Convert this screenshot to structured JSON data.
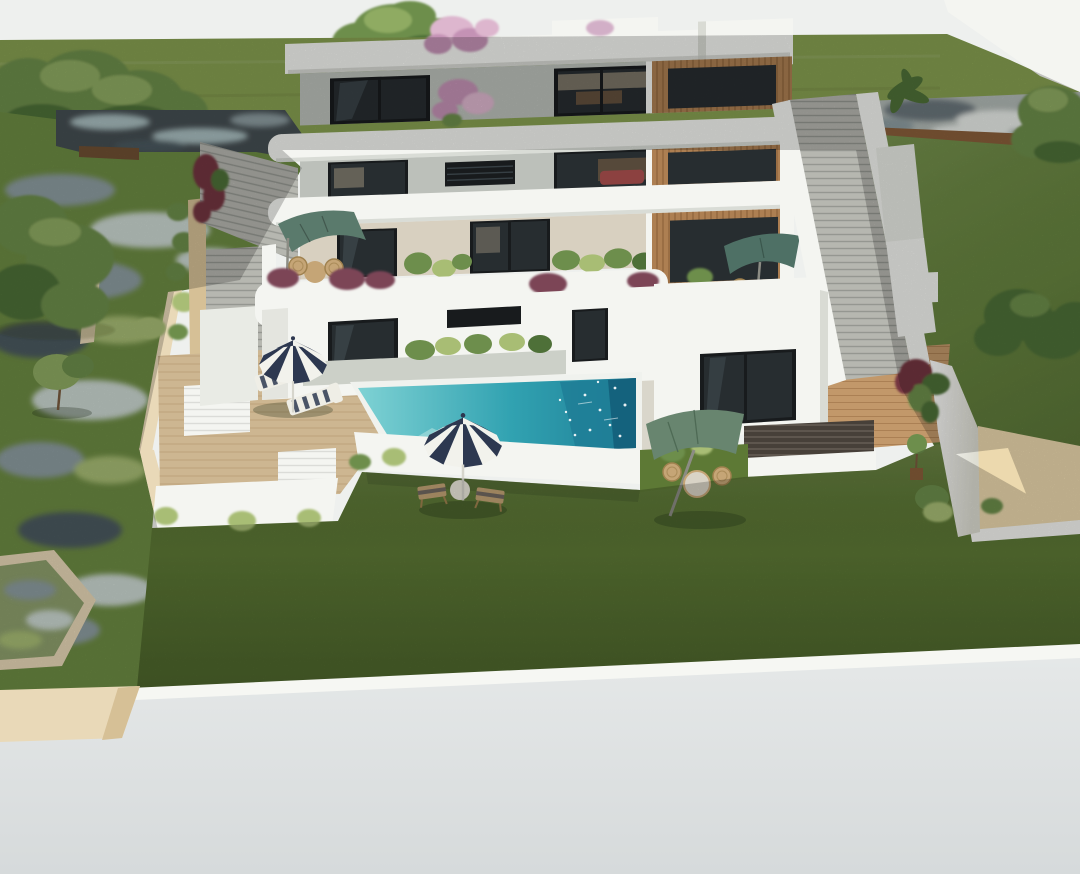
{
  "scene": {
    "type": "architectural_3d_render",
    "subject": "modern terraced hillside apartment villa with infinity pool, lawn, patio umbrellas and staircases"
  },
  "colors": {
    "sky": "#eef0ee",
    "hill": "#87a051",
    "slope": "#6d8c43",
    "lawn": "#5d7935",
    "grassLight": "#a8bd74",
    "treeGreen": "#6d8e4c",
    "treeDark": "#4e7038",
    "treeLight": "#8fab62",
    "trunk": "#7a5b3e",
    "pondDark": "#454e52",
    "pondLight": "#a9bec0",
    "streamLight": "#ccd8d2",
    "streamGray": "#8d9da1",
    "streamDark": "#4c5a60",
    "pondMoss": "#8ea06d",
    "stoneBase": "#b2bab6",
    "stoneLight": "#e9ede9",
    "stoneDark": "#6b767c",
    "corten": "#8a5f3a",
    "fence": "#6f5033",
    "white": "#f4f5f1",
    "whiteSoft": "#e9ebe5",
    "whiteShade": "#d9dbd4",
    "whiteDark": "#c3c6bf",
    "wallGray": "#bcc0ba",
    "wallBeige": "#d8d0c0",
    "glassFrame": "#181b1d",
    "glass": "#272d30",
    "glassLight": "#4b585e",
    "interiorWarm": "#63503d",
    "interiorLight": "#c0ae94",
    "sofaRed": "#8c4140",
    "slatWood": "#ad7f52",
    "slatLine": "#6f4a26",
    "deck": "#cdb691",
    "deckLine": "#a8895f",
    "warmDeck": "#c2986a",
    "warmDeckLine": "#8a5c30",
    "brick": "#474039",
    "brickLine": "#d9cfc0",
    "stair": "#b6b7b0",
    "tread": "#3f4440",
    "pool1": "#7fd2d4",
    "pool2": "#31a2b1",
    "poolDark": "#1f7e96",
    "poolDeep": "#135f7a",
    "coping": "#f0f2ee",
    "terrace": "#d9d6cb",
    "planter": "#ccd0c8",
    "umbNavy": "#2d3850",
    "umbWhite": "#f2f2ec",
    "umbGreenA": "#5a7a6c",
    "umbGreenB": "#4e7065",
    "umbGreenC": "#68856f",
    "pole": "#d6d5cc",
    "poleDark": "#8c8c84",
    "blossom": "#c492b5",
    "blossomLight": "#ddb6ce",
    "vine": "#73343f",
    "purple": "#7b4457",
    "sand": "#ecd9ae",
    "beige": "#e9d9b8",
    "beigeShade": "#d6c096",
    "pavement": "#dee2e2",
    "curb": "#f6f7f3",
    "wicker": "#c5a576",
    "wickerDark": "#a0824f",
    "shadow": "rgba(30,42,22,0.28)",
    "shadowSoft": "rgba(30,42,22,0.16)"
  }
}
